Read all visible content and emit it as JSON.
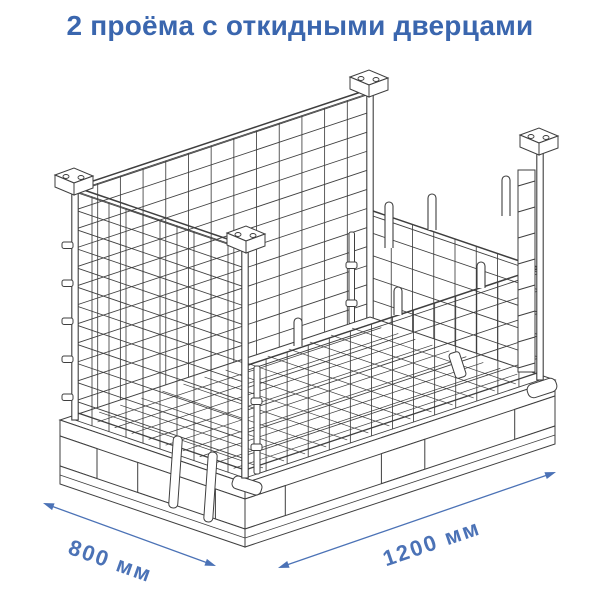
{
  "title": {
    "text": "2 проёма с откидными дверцами",
    "color": "#3a66ae"
  },
  "dimensions": {
    "width_label": "800 мм",
    "length_label": "1200 мм",
    "color": "#4b72b6"
  },
  "drawing": {
    "label": "pallet-mesh-cage-with-two-drop-gate-openings",
    "stroke_color": "#3f3f3f",
    "background": "#ffffff"
  }
}
